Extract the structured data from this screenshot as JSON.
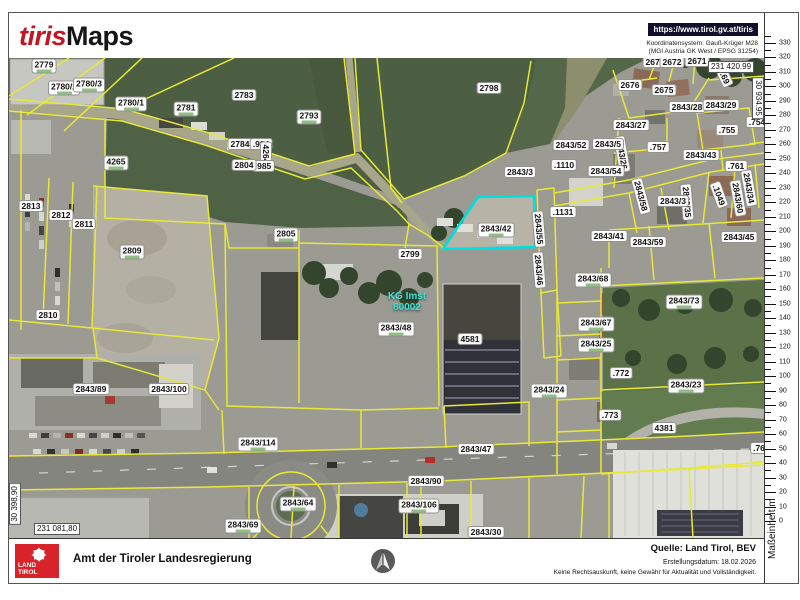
{
  "header": {
    "logo_tiris": "tiris",
    "logo_maps": "Maps",
    "url": "https://www.tirol.gv.at/tiris",
    "coord_system_line1": "Koordinatensystem: Gauß-Krüger M28",
    "coord_system_line2": "(MGI Austria GK West / EPSG 31254)"
  },
  "map": {
    "kg_label": {
      "line1": "KG Imst",
      "line2": "80002"
    },
    "highlight_parcel": "2843/42",
    "highlight_color": "#00dfdf",
    "parcel_line_color": "#e8e838",
    "coordinates": [
      {
        "text": "231 420.99",
        "x": 722,
        "y": 9
      },
      {
        "text": "30 934.95",
        "x": 749,
        "y": 40,
        "rot": 90
      },
      {
        "text": "231 081,80",
        "x": 48,
        "y": 471
      },
      {
        "text": "30 398,90",
        "x": 6,
        "y": 446,
        "rot": -90
      }
    ],
    "parcels": [
      {
        "label": "2779",
        "x": 35,
        "y": 8,
        "area": true
      },
      {
        "label": "2780/2",
        "x": 55,
        "y": 30,
        "area": true
      },
      {
        "label": "2780/3",
        "x": 80,
        "y": 27,
        "area": true
      },
      {
        "label": "2780/1",
        "x": 122,
        "y": 46,
        "area": true
      },
      {
        "label": "2781",
        "x": 177,
        "y": 51,
        "area": true
      },
      {
        "label": "2783",
        "x": 235,
        "y": 37
      },
      {
        "label": "2784",
        "x": 231,
        "y": 86
      },
      {
        "label": ".984",
        "x": 252,
        "y": 86
      },
      {
        "label": "4264",
        "x": 257,
        "y": 96,
        "rot": 90
      },
      {
        "label": ".985",
        "x": 254,
        "y": 108
      },
      {
        "label": "4265",
        "x": 107,
        "y": 105,
        "area": true
      },
      {
        "label": "2804",
        "x": 235,
        "y": 107
      },
      {
        "label": "2793",
        "x": 300,
        "y": 59,
        "area": true
      },
      {
        "label": "2798",
        "x": 480,
        "y": 30
      },
      {
        "label": "2805",
        "x": 277,
        "y": 177,
        "area": true
      },
      {
        "label": "2799",
        "x": 401,
        "y": 196
      },
      {
        "label": "2843/48",
        "x": 387,
        "y": 271,
        "area": true
      },
      {
        "label": "2843/42",
        "x": 487,
        "y": 172,
        "area": true
      },
      {
        "label": ".1131",
        "x": 554,
        "y": 154
      },
      {
        "label": "2843/55",
        "x": 530,
        "y": 171,
        "rot": 85
      },
      {
        "label": "2843/46",
        "x": 530,
        "y": 212,
        "rot": 85
      },
      {
        "label": "2843/41",
        "x": 600,
        "y": 178
      },
      {
        "label": "2843/59",
        "x": 639,
        "y": 184
      },
      {
        "label": "2843/45",
        "x": 730,
        "y": 179
      },
      {
        "label": "2843/68",
        "x": 584,
        "y": 222,
        "area": true
      },
      {
        "label": "2843/73",
        "x": 675,
        "y": 244,
        "area": true
      },
      {
        "label": "2843/67",
        "x": 587,
        "y": 266,
        "area": true
      },
      {
        "label": "2843/25",
        "x": 587,
        "y": 287,
        "area": true
      },
      {
        "label": ".772",
        "x": 612,
        "y": 315
      },
      {
        "label": "2843/24",
        "x": 540,
        "y": 333,
        "area": true
      },
      {
        "label": "2843/23",
        "x": 677,
        "y": 328,
        "area": true
      },
      {
        "label": ".773",
        "x": 601,
        "y": 357
      },
      {
        "label": "4381",
        "x": 655,
        "y": 370
      },
      {
        "label": "2813",
        "x": 22,
        "y": 148
      },
      {
        "label": "2812",
        "x": 52,
        "y": 157
      },
      {
        "label": "2811",
        "x": 75,
        "y": 166
      },
      {
        "label": "2809",
        "x": 123,
        "y": 194,
        "area": true
      },
      {
        "label": "2810",
        "x": 39,
        "y": 257
      },
      {
        "label": "2843/89",
        "x": 82,
        "y": 331
      },
      {
        "label": "2843/100",
        "x": 160,
        "y": 331
      },
      {
        "label": "2843/114",
        "x": 249,
        "y": 386,
        "area": true
      },
      {
        "label": "2843/90",
        "x": 417,
        "y": 423
      },
      {
        "label": "2843/64",
        "x": 289,
        "y": 446,
        "area": true
      },
      {
        "label": "2843/69",
        "x": 234,
        "y": 468,
        "area": true
      },
      {
        "label": "2843/106",
        "x": 410,
        "y": 448,
        "area": true
      },
      {
        "label": "2843/30",
        "x": 477,
        "y": 474
      },
      {
        "label": "2843/47",
        "x": 467,
        "y": 391
      },
      {
        "label": ".76",
        "x": 750,
        "y": 390
      },
      {
        "label": "4581",
        "x": 461,
        "y": 281
      },
      {
        "label": "2674",
        "x": 646,
        "y": 4
      },
      {
        "label": "2672",
        "x": 663,
        "y": 4
      },
      {
        "label": "2671",
        "x": 688,
        "y": 3
      },
      {
        "label": ".69",
        "x": 716,
        "y": 20,
        "rot": 65
      },
      {
        "label": "2676",
        "x": 621,
        "y": 27
      },
      {
        "label": "2675",
        "x": 655,
        "y": 32
      },
      {
        "label": "2843/28",
        "x": 678,
        "y": 49
      },
      {
        "label": "2843/29",
        "x": 712,
        "y": 47
      },
      {
        "label": "2843/27",
        "x": 622,
        "y": 67
      },
      {
        "label": ".755",
        "x": 718,
        "y": 72
      },
      {
        "label": ".754",
        "x": 748,
        "y": 64
      },
      {
        "label": "2843/26",
        "x": 613,
        "y": 96,
        "rot": 80
      },
      {
        "label": "2843/52",
        "x": 562,
        "y": 87
      },
      {
        "label": "2843/5",
        "x": 599,
        "y": 86
      },
      {
        "label": ".757",
        "x": 649,
        "y": 89
      },
      {
        "label": ".1110",
        "x": 555,
        "y": 107
      },
      {
        "label": "2843/3",
        "x": 511,
        "y": 114
      },
      {
        "label": "2843/54",
        "x": 597,
        "y": 113
      },
      {
        "label": "2843/43",
        "x": 692,
        "y": 97
      },
      {
        "label": ".761",
        "x": 727,
        "y": 108
      },
      {
        "label": "2843/58",
        "x": 632,
        "y": 138,
        "rot": 75
      },
      {
        "label": "2843/35",
        "x": 678,
        "y": 144,
        "rot": 85
      },
      {
        "label": ".1049",
        "x": 710,
        "y": 137,
        "rot": 70
      },
      {
        "label": "2843/60",
        "x": 729,
        "y": 140,
        "rot": 80
      },
      {
        "label": "2843/34",
        "x": 740,
        "y": 130,
        "rot": 80
      },
      {
        "label": "2843/3",
        "x": 664,
        "y": 143
      }
    ]
  },
  "ruler": {
    "unit_label": "Maßeinheit m",
    "max": 330,
    "min": 0,
    "step": 10
  },
  "footer": {
    "logo_line1": "LAND",
    "logo_line2": "TIROL",
    "agency": "Amt der Tiroler Landesregierung",
    "source": "Quelle: Land Tirol, BEV",
    "created": "Erstellungsdatum:  18.02.2026",
    "disclaimer": "Keine Rechtsauskunft, keine Gewähr für Aktualität und Vollständigkeit."
  }
}
